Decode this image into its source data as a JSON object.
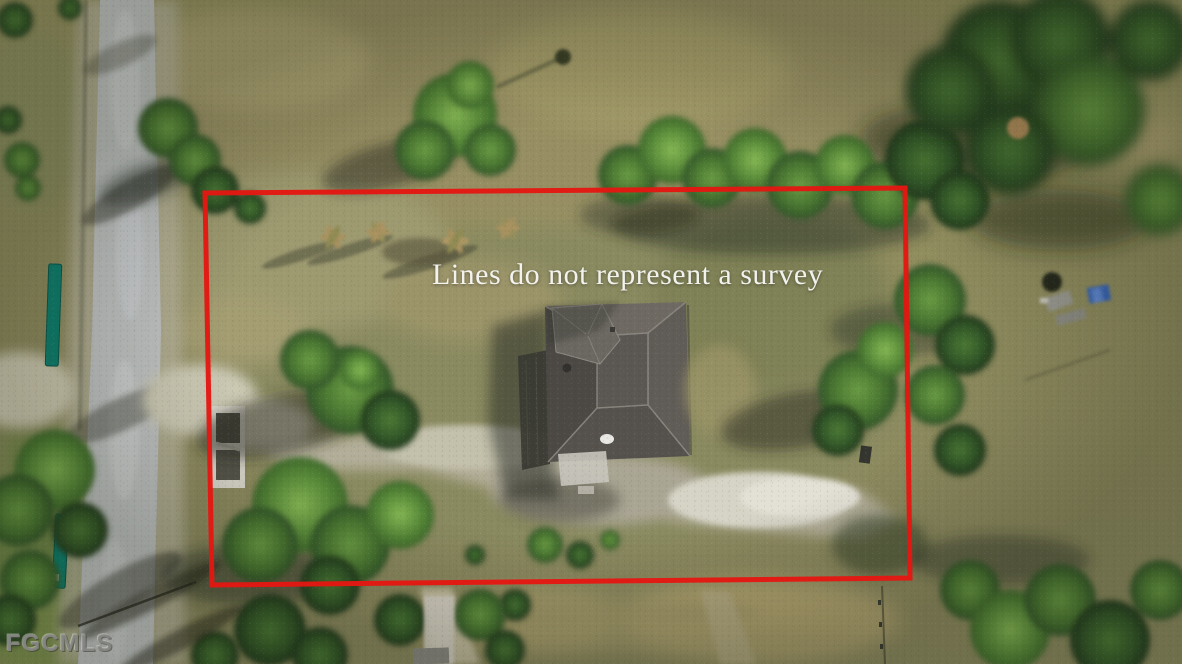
{
  "overlay": {
    "disclaimer": "Lines do not represent a survey",
    "watermark": "FGCMLS"
  },
  "boundary": {
    "color": "#e41712",
    "points": "205,193 905,188 910,578 212,585",
    "stroke_width": 5
  },
  "palette": {
    "grass_olive": "#8f8b62",
    "road_gray": "#c0c3c2",
    "gravel_tan": "#c9c6b2",
    "roof_gray": "#5b5753",
    "tree_green": "#57893a",
    "shed_teal": "#0f8170",
    "tarp_blue": "#3b66b5",
    "shadow_dark": "#242720"
  },
  "scene": {
    "kind": "aerial-drone-photo",
    "elements": [
      "rural-road-left",
      "grassy-lot",
      "house-gray-hip-roof",
      "gravel-driveway",
      "scattered-trees",
      "teal-sheds",
      "dense-tree-line-right",
      "red-property-outline"
    ]
  }
}
